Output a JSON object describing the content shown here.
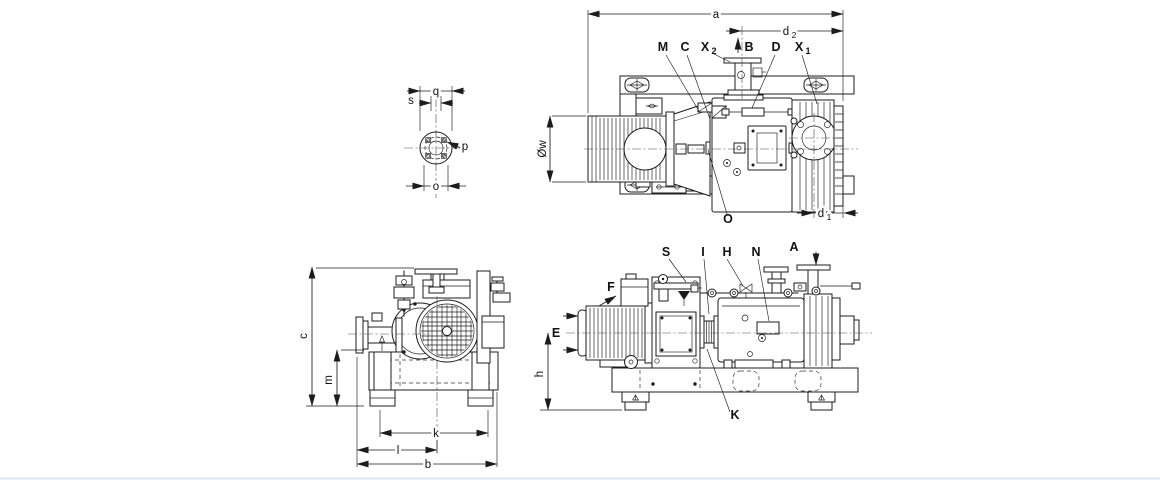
{
  "drawing": {
    "colors": {
      "line": "#1c1c1c",
      "background": "#ffffff",
      "bottom_edge_tint": "#d9e5ef"
    },
    "views": {
      "flange_detail": {
        "dims": {
          "q": "q",
          "s": "s",
          "p": "p",
          "o": "o"
        }
      },
      "top_view": {
        "dims": {
          "a": "a",
          "w": "Øw",
          "d2": {
            "base": "d",
            "sub": "2"
          },
          "d1": {
            "base": "d",
            "sub": "1"
          }
        },
        "port_labels": {
          "M": "M",
          "C": "C",
          "X2": {
            "base": "X",
            "sub": "2"
          },
          "B": "B",
          "D": "D",
          "X1": {
            "base": "X",
            "sub": "1"
          },
          "O": "O"
        }
      },
      "front_view": {
        "dims": {
          "c": "c",
          "m": "m",
          "k": "k",
          "l": "l",
          "b": "b"
        }
      },
      "side_view": {
        "dims": {
          "h": "h"
        },
        "labels": {
          "S": "S",
          "I": "I",
          "H": "H",
          "N": "N",
          "A": "A",
          "F": "F",
          "E": "E",
          "K": "K"
        }
      }
    }
  }
}
